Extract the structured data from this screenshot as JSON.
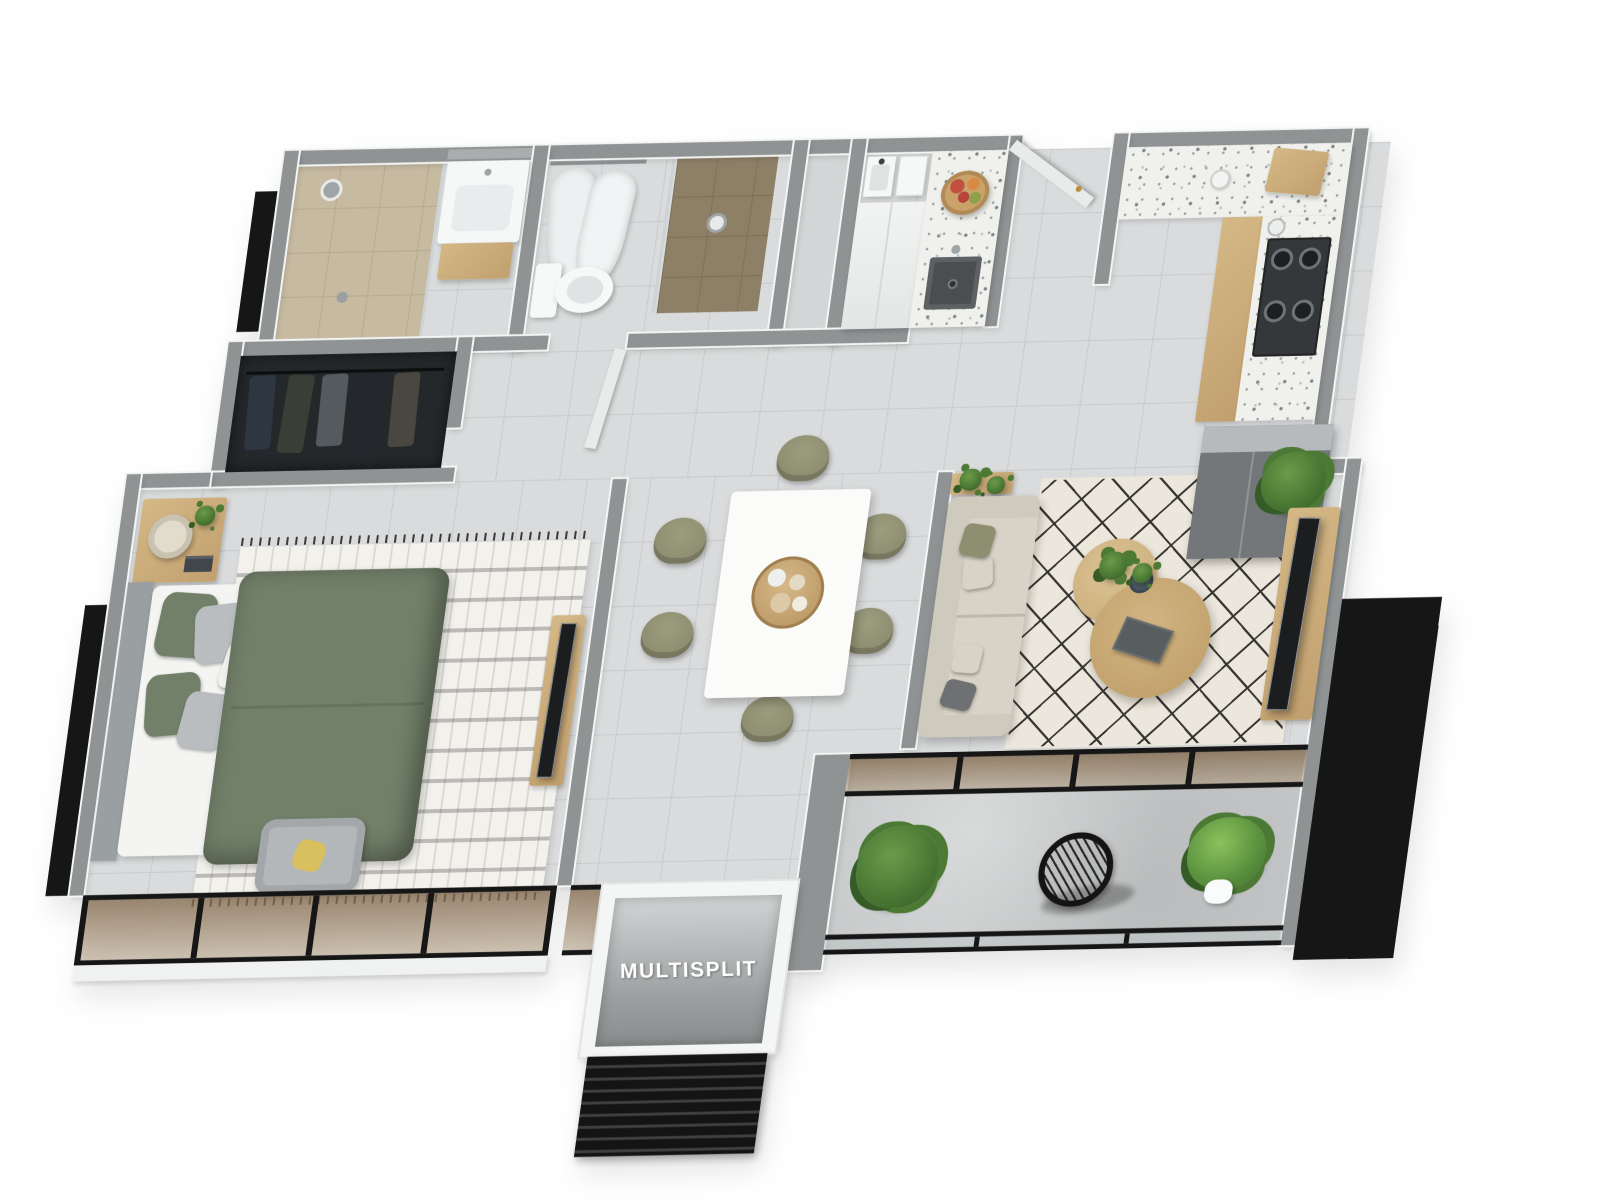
{
  "labels": {
    "ac_unit": "MULTISPLIT"
  },
  "colors": {
    "wall_top": "#8f9394",
    "wall_face": "#f4f5f5",
    "floor_tile": "#d9dbdc",
    "floor_grout": "#c8cacc",
    "bath_tile": "#c6baa1",
    "bath_grout": "#b5a98f",
    "bath_dark": "#8d8067",
    "bath_dark_grout": "#7d7158",
    "concrete": "#c5c7c8",
    "terrazzo": "#f0f0ec",
    "duvet": "#72806a",
    "headboard": "#9aa0a2",
    "pillow_gray": "#b9bdbf",
    "wood": "#c2a06f",
    "wood_light": "#d4b886",
    "black": "#161616",
    "glass_bronze_1": "rgba(130,106,77,0.78)",
    "glass_bronze_2": "rgba(166,143,112,0.5)",
    "sofa": "#d8d3c7",
    "sofa_back": "#cfcabe",
    "rug_cream": "#ece7dc",
    "rug_line": "#35332f",
    "rug_bed": "#f3f1ec",
    "olive": "#8e8e71",
    "plant": "#4c7a35",
    "plant_dark": "#355c26",
    "fridge": "#73777a",
    "fridge_top": "#b7babc",
    "tv_black": "#1b1d1e",
    "gold": "#b98f3e",
    "white_obj": "#f6f7f7",
    "mirror": "#a9adae",
    "sink_dark": "#4a4e50",
    "steel": "#9fa4a7",
    "bowl_tan": "#caa36a",
    "apple_red": "#c24f3f",
    "chair_gray": "#b3b7b9",
    "cushion_yellow": "#d8c05e",
    "door_leaf": "#e9ebeb",
    "louver_dark": "#141414",
    "louver_line": "#3f3f3f",
    "label_text": "#ffffff"
  }
}
